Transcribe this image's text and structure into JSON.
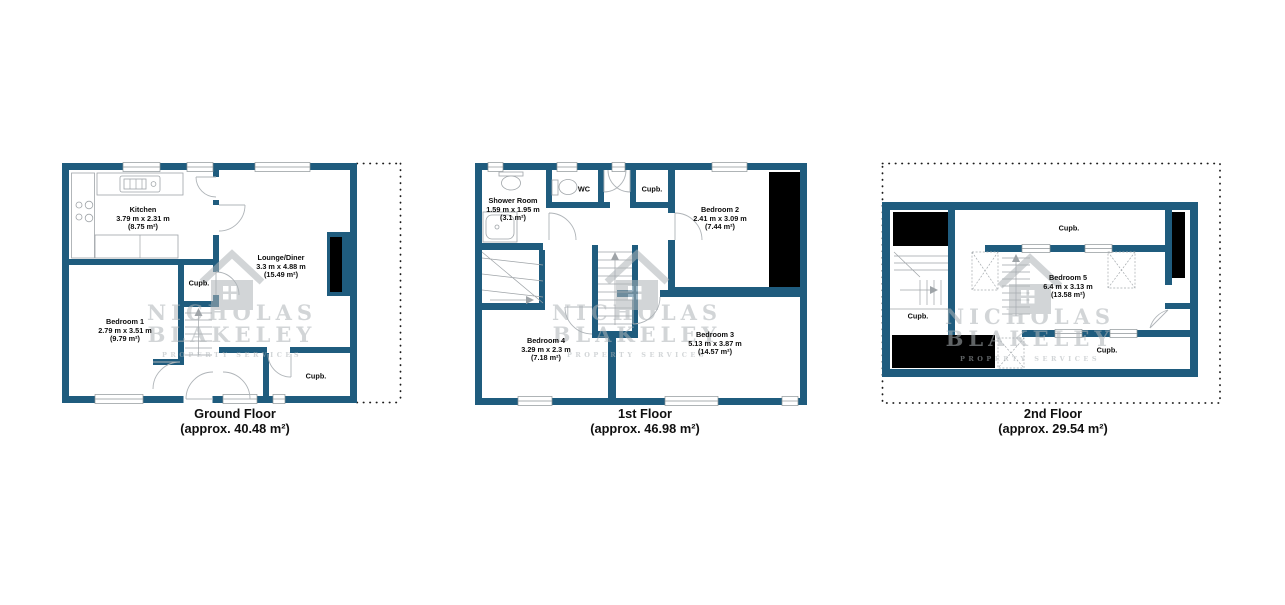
{
  "watermark": {
    "line1": "NICHOLAS",
    "line2": "BLAKELEY",
    "line3": "PROPERTY SERVICES"
  },
  "colors": {
    "wall": "#1F5C7E",
    "feature_black": "#000000",
    "watermark_gray": "#D2D6D9",
    "text": "#0d0d0d"
  },
  "floors": [
    {
      "id": "ground-floor",
      "title": "Ground Floor",
      "area": "(approx. 40.48 m²)",
      "rooms": [
        {
          "name": "Kitchen",
          "dims": "3.79 m x 2.31 m",
          "area": "(8.75 m²)"
        },
        {
          "name": "Lounge/Diner",
          "dims": "3.3 m x 4.88 m",
          "area": "(15.49 m²)"
        },
        {
          "name": "Bedroom 1",
          "dims": "2.79 m x 3.51 m",
          "area": "(9.79 m²)"
        },
        {
          "name": "Cupb."
        },
        {
          "name": "Cupb."
        }
      ]
    },
    {
      "id": "first-floor",
      "title": "1st Floor",
      "area": "(approx. 46.98 m²)",
      "rooms": [
        {
          "name": "Shower Room",
          "dims": "1.59 m x 1.95 m",
          "area": "(3.1 m²)"
        },
        {
          "name": "WC"
        },
        {
          "name": "Cupb."
        },
        {
          "name": "Bedroom 2",
          "dims": "2.41 m x 3.09 m",
          "area": "(7.44 m²)"
        },
        {
          "name": "Bedroom 4",
          "dims": "3.29 m x 2.3 m",
          "area": "(7.18 m²)"
        },
        {
          "name": "Bedroom 3",
          "dims": "5.13 m x 3.87 m",
          "area": "(14.57 m²)"
        }
      ]
    },
    {
      "id": "second-floor",
      "title": "2nd Floor",
      "area": "(approx. 29.54 m²)",
      "rooms": [
        {
          "name": "Cupb."
        },
        {
          "name": "Bedroom 5",
          "dims": "6.4 m x 3.13 m",
          "area": "(13.58 m²)"
        },
        {
          "name": "Cupb."
        },
        {
          "name": "Cupb."
        }
      ]
    }
  ]
}
